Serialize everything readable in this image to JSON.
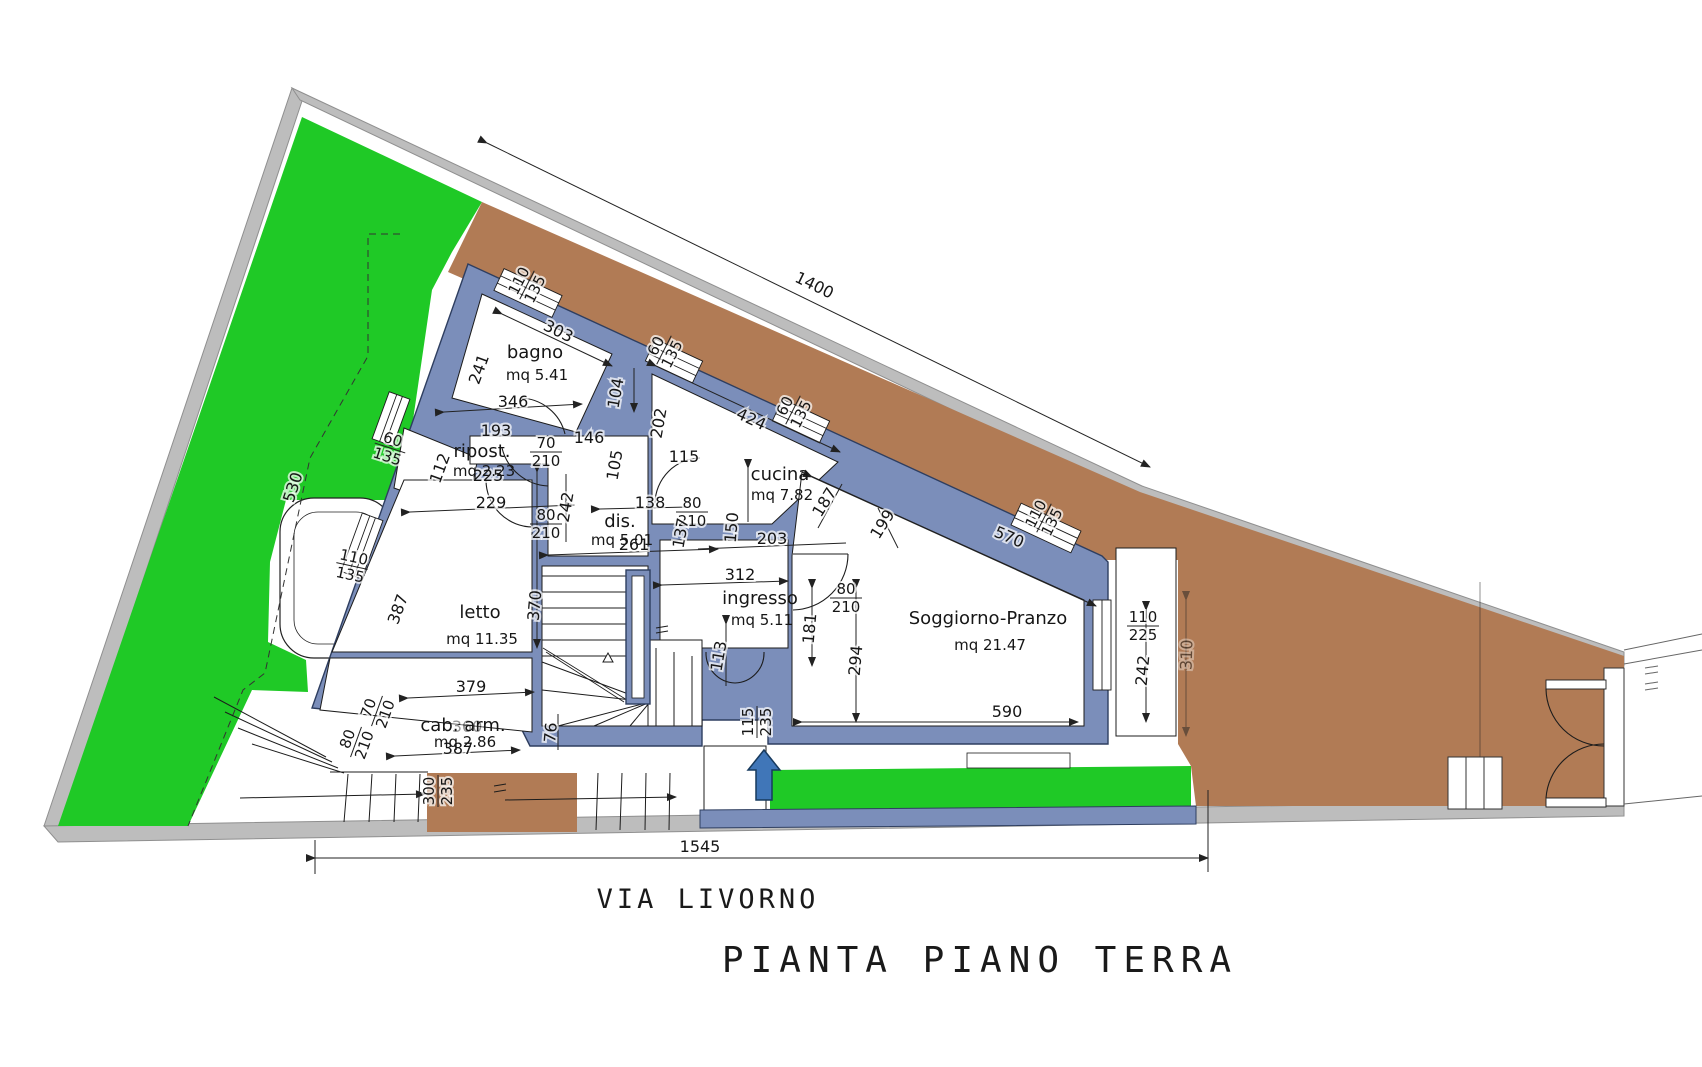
{
  "title": "PIANTA PIANO TERRA",
  "street_label": "VIA LIVORNO",
  "colors": {
    "garden": "#1fc926",
    "terrace": "#b17b55",
    "wall": "#7b8eba",
    "wall_edge": "#2e3e60",
    "boundary": "#bdbdbd",
    "arrow": "#4076b8",
    "paper": "#ffffff"
  },
  "rooms": [
    {
      "name": "bagno",
      "area": "mq 5.41",
      "x": 535,
      "y": 358,
      "dy": 22
    },
    {
      "name": "ripost.",
      "area": "mq 2.23",
      "x": 482,
      "y": 457,
      "dy": 19
    },
    {
      "name": "dis.",
      "area": "mq 5.01",
      "x": 620,
      "y": 527,
      "dy": 18
    },
    {
      "name": "cucina",
      "area": "mq 7.82",
      "x": 780,
      "y": 480,
      "dy": 20
    },
    {
      "name": "ingresso",
      "area": "mq 5.11",
      "x": 760,
      "y": 604,
      "dy": 21
    },
    {
      "name": "letto",
      "area": "mq 11.35",
      "x": 480,
      "y": 618,
      "dy": 26
    },
    {
      "name": "cab. arm.",
      "area": "mq 2.86",
      "x": 463,
      "y": 731,
      "dy": 16,
      "ghost": "360"
    },
    {
      "name": "Soggiorno-Pranzo",
      "area": "mq 21.47",
      "x": 988,
      "y": 624,
      "dy": 26
    }
  ],
  "dimensions": [
    {
      "t": "1400",
      "x": 812,
      "y": 290,
      "r": 26
    },
    {
      "t": "1545",
      "x": 700,
      "y": 852,
      "r": 0
    },
    {
      "t": "530",
      "x": 298,
      "y": 489,
      "r": -72
    },
    {
      "t": "303",
      "x": 556,
      "y": 336,
      "r": 26
    },
    {
      "t": "241",
      "x": 484,
      "y": 371,
      "r": -70
    },
    {
      "t": "346",
      "x": 513,
      "y": 407,
      "r": 0
    },
    {
      "t": "193",
      "x": 496,
      "y": 436,
      "r": 0
    },
    {
      "t": "225",
      "x": 488,
      "y": 481,
      "r": 0
    },
    {
      "t": "229",
      "x": 491,
      "y": 508,
      "r": 0
    },
    {
      "t": "104",
      "x": 621,
      "y": 394,
      "r": -80
    },
    {
      "t": "202",
      "x": 664,
      "y": 424,
      "r": -80
    },
    {
      "t": "146",
      "x": 589,
      "y": 443,
      "r": 0
    },
    {
      "t": "105",
      "x": 620,
      "y": 466,
      "r": -80
    },
    {
      "t": "115",
      "x": 684,
      "y": 462,
      "r": 0
    },
    {
      "t": "112",
      "x": 445,
      "y": 470,
      "r": -70
    },
    {
      "t": "242",
      "x": 571,
      "y": 508,
      "r": -80
    },
    {
      "t": "138",
      "x": 650,
      "y": 508,
      "r": 0
    },
    {
      "t": "137",
      "x": 686,
      "y": 534,
      "r": -80
    },
    {
      "t": "150",
      "x": 737,
      "y": 528,
      "r": -85
    },
    {
      "t": "203",
      "x": 772,
      "y": 544,
      "r": 0
    },
    {
      "t": "424",
      "x": 749,
      "y": 424,
      "r": 25
    },
    {
      "t": "187",
      "x": 829,
      "y": 505,
      "r": -58
    },
    {
      "t": "199",
      "x": 887,
      "y": 527,
      "r": -58
    },
    {
      "t": "570",
      "x": 1007,
      "y": 542,
      "r": 23
    },
    {
      "t": "261",
      "x": 634,
      "y": 550,
      "r": 0
    },
    {
      "t": "312",
      "x": 740,
      "y": 580,
      "r": 0
    },
    {
      "t": "370",
      "x": 540,
      "y": 606,
      "r": -85
    },
    {
      "t": "387",
      "x": 403,
      "y": 611,
      "r": -70
    },
    {
      "t": "181",
      "x": 815,
      "y": 629,
      "r": -85
    },
    {
      "t": "113",
      "x": 724,
      "y": 657,
      "r": -80
    },
    {
      "t": "294",
      "x": 861,
      "y": 661,
      "r": -85
    },
    {
      "t": "242",
      "x": 1148,
      "y": 671,
      "r": -85
    },
    {
      "t": "590",
      "x": 1007,
      "y": 717,
      "r": 0
    },
    {
      "t": "379",
      "x": 471,
      "y": 692,
      "r": 0
    },
    {
      "t": "387",
      "x": 458,
      "y": 754,
      "r": 0
    },
    {
      "t": "76",
      "x": 556,
      "y": 733,
      "r": -85
    },
    {
      "t": "310",
      "x": 1192,
      "y": 655,
      "r": -88,
      "faint": true
    }
  ],
  "fractions": [
    {
      "top": "110",
      "bottom": "135",
      "x": 527,
      "y": 285,
      "r": -63
    },
    {
      "top": "60",
      "bottom": "135",
      "x": 664,
      "y": 350,
      "r": -63
    },
    {
      "top": "60",
      "bottom": "135",
      "x": 793,
      "y": 410,
      "r": -63
    },
    {
      "top": "110",
      "bottom": "135",
      "x": 1044,
      "y": 518,
      "r": -63
    },
    {
      "top": "60",
      "bottom": "135",
      "x": 390,
      "y": 448,
      "r": 18
    },
    {
      "top": "110",
      "bottom": "135",
      "x": 352,
      "y": 566,
      "r": 12
    },
    {
      "top": "110",
      "bottom": "225",
      "x": 1143,
      "y": 626,
      "r": 0
    },
    {
      "top": "115",
      "bottom": "235",
      "x": 757,
      "y": 722,
      "r": -90
    },
    {
      "top": "300",
      "bottom": "235",
      "x": 438,
      "y": 791,
      "r": -90
    },
    {
      "top": "80",
      "bottom": "210",
      "x": 356,
      "y": 742,
      "r": -70
    },
    {
      "top": "70",
      "bottom": "210",
      "x": 377,
      "y": 711,
      "r": -70
    },
    {
      "top": "70",
      "bottom": "210",
      "x": 546,
      "y": 452,
      "r": 0
    },
    {
      "top": "80",
      "bottom": "210",
      "x": 546,
      "y": 524,
      "r": 0
    },
    {
      "top": "80",
      "bottom": "210",
      "x": 846,
      "y": 598,
      "r": 0
    },
    {
      "top": "80",
      "bottom": "210",
      "x": 692,
      "y": 512,
      "r": 0
    }
  ]
}
